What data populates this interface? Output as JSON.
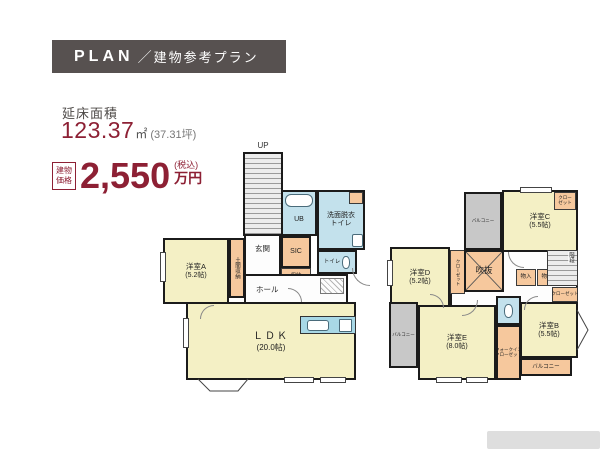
{
  "header": {
    "en": "PLAN",
    "sep": "／",
    "ja": "建物参考プラン"
  },
  "summary": {
    "area_label": "延床面積",
    "area_value": "123.37",
    "area_unit": "㎡",
    "area_tsubo": "(37.31坪)",
    "price_label1": "建物",
    "price_label2": "価格",
    "price_value": "2,550",
    "price_tax": "(税込)",
    "price_unit": "万円"
  },
  "floor1": {
    "up": "UP",
    "room_a": {
      "name": "洋室A",
      "size": "(5.2帖)"
    },
    "doma": "土間収納",
    "genkan": "玄関",
    "sic": "SIC",
    "shuno": "収納",
    "ub": "UB",
    "senmen1": "洗面脱衣",
    "senmen2": "トイレ",
    "toilet": "トイレ",
    "hall": "ホール",
    "ldk": {
      "name": "ＬＤＫ",
      "size": "(20.0帖)"
    }
  },
  "floor2": {
    "balcony_top": "バルコニー",
    "balcony_left": "バルコニー",
    "balcony_bottom": "バルコニー",
    "room_c": {
      "name": "洋室C",
      "size": "(5.5帖)"
    },
    "room_d": {
      "name": "洋室D",
      "size": "(5.2帖)"
    },
    "room_b": {
      "name": "洋室B",
      "size": "(5.5帖)"
    },
    "room_e": {
      "name": "洋室E",
      "size": "(8.0帖)"
    },
    "fukinuke": "吹抜",
    "monoiri": "物入",
    "kaidan": "階段",
    "closet": "クローゼット",
    "closet_l1": "クロー",
    "closet_l2": "ゼット",
    "wic1": "ウォークイン",
    "wic2": "クローゼット"
  },
  "colors": {
    "accent": "#8d2034",
    "header_bg": "#575150",
    "room_yellow": "#f4f0c5",
    "wet_blue": "#c3e1ec",
    "storage_orange": "#f6c89d",
    "balcony_gray": "#c8c8c8"
  }
}
